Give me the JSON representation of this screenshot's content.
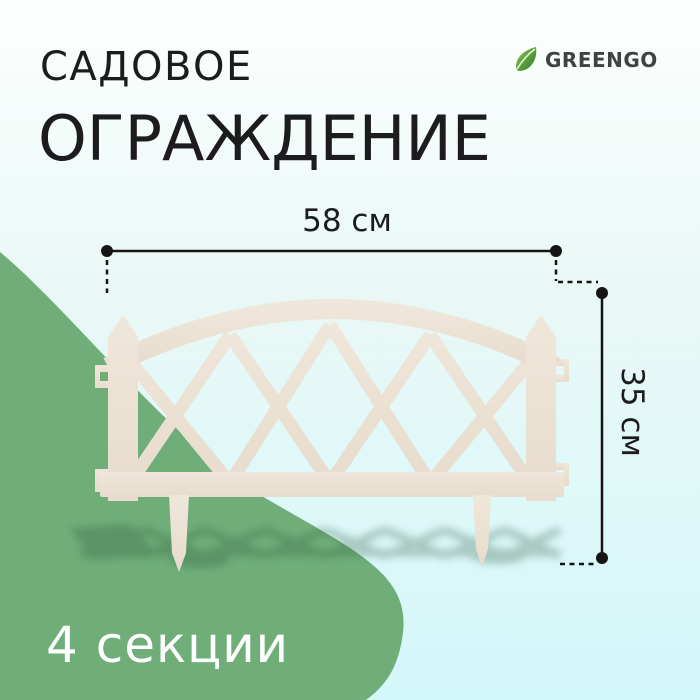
{
  "title": {
    "line1": "САДОВОЕ",
    "line2": "ОГРАЖДЕНИЕ"
  },
  "brand": {
    "name": "GREENGO"
  },
  "dimensions": {
    "width": "58 см",
    "height": "35 см"
  },
  "badge": {
    "sections": "4 секции"
  },
  "colors": {
    "background_top": "#fdfffe",
    "background_mid": "#e9f8f6",
    "background_bottom": "#d4f7fa",
    "blob_green": "#6fae79",
    "fence_light": "#efe7da",
    "fence_cream": "#e7dccd",
    "shadow_green": "#2f5a3d",
    "text_dark": "#1c1c1e",
    "brand_gray": "#3d4442",
    "leaf_light": "#8cc64d",
    "leaf_dark": "#2f7a33",
    "badge_white": "#ffffff",
    "dimension_line": "#151515"
  }
}
